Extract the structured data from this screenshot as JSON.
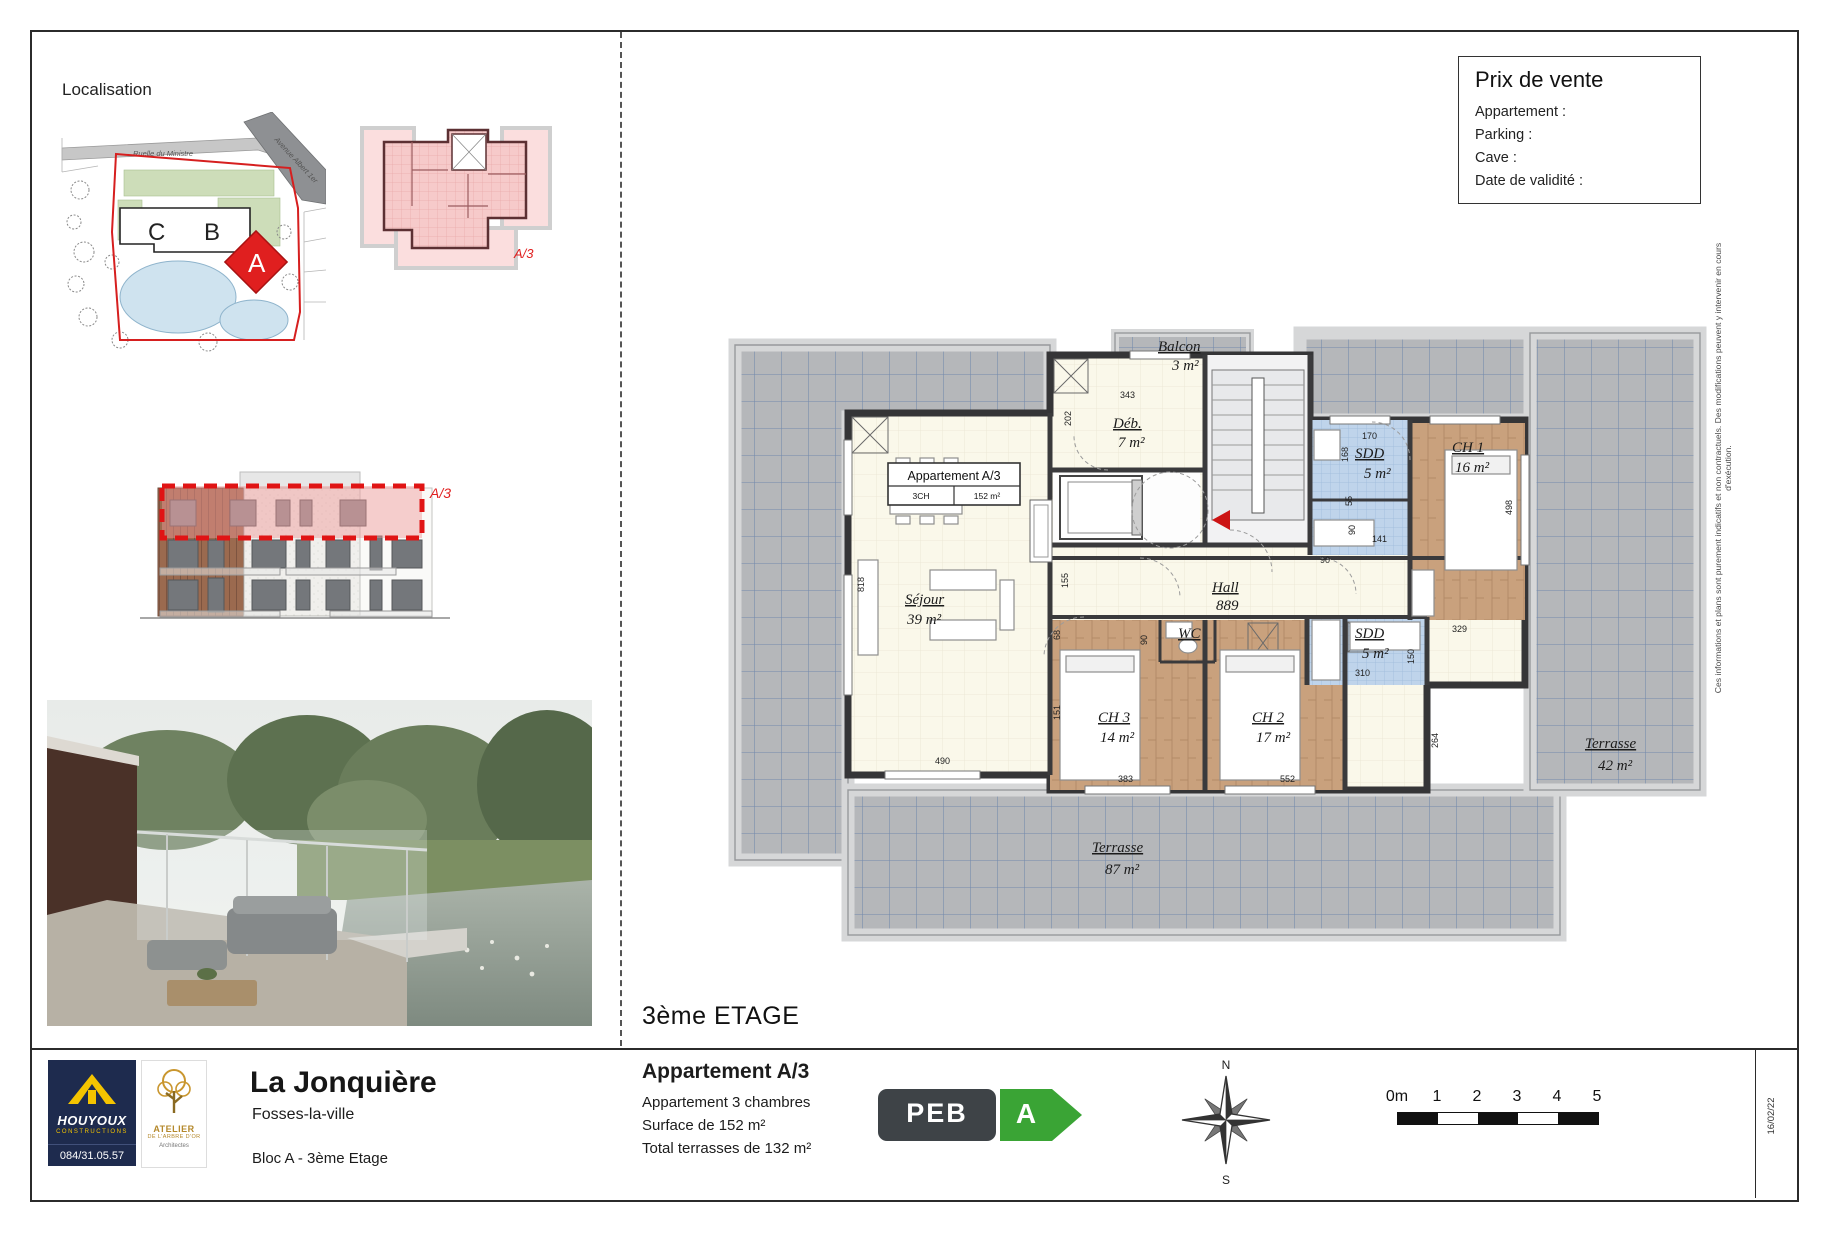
{
  "page": {
    "localisation_label": "Localisation",
    "floor_label": "3ème ETAGE",
    "date_label": "16/02/22",
    "disclaimer": "Ces informations et plans sont purement indicatifs et non contractuels. Des modifications peuvent y intervenir en cours d'exécution."
  },
  "price_box": {
    "title": "Prix de vente",
    "line1": "Appartement :",
    "line2": "Parking :",
    "line3": "Cave :",
    "line4": "Date de validité :"
  },
  "map": {
    "road1": "Ruelle du Ministre",
    "road2": "Avenue Albert 1er",
    "building_c": "C",
    "building_b": "B",
    "building_a": "A"
  },
  "keyplan": {
    "unit": "A/3"
  },
  "elevation": {
    "unit": "A/3"
  },
  "plan": {
    "unit_box": {
      "title": "Appartement A/3",
      "col1": "3CH",
      "col2": "152 m²"
    },
    "rooms": {
      "sejour": {
        "name": "Séjour",
        "area": "39 m²"
      },
      "deb": {
        "name": "Déb.",
        "area": "7 m²"
      },
      "hall": {
        "name": "Hall",
        "area": "889"
      },
      "sdd1": {
        "name": "SDD",
        "area": "5 m²"
      },
      "ch1": {
        "name": "CH 1",
        "area": "16 m²"
      },
      "wc": {
        "name": "WC"
      },
      "ch3": {
        "name": "CH 3",
        "area": "14 m²"
      },
      "ch2": {
        "name": "CH 2",
        "area": "17 m²"
      },
      "sdd2": {
        "name": "SDD",
        "area": "5 m²"
      },
      "balcon": {
        "name": "Balcon",
        "area": "3 m²"
      },
      "terrasse_right": {
        "name": "Terrasse",
        "area": "42 m²"
      },
      "terrasse_bottom": {
        "name": "Terrasse",
        "area": "87 m²"
      }
    },
    "dims": {
      "d343": "343",
      "d202": "202",
      "d818": "818",
      "d490": "490",
      "d155": "155",
      "d68": "68",
      "d151": "151",
      "d170": "170",
      "d168": "168",
      "d55": "55",
      "d90a": "90",
      "d141": "141",
      "d90b": "90",
      "d90c": "90",
      "d310": "310",
      "d150": "150",
      "d383": "383",
      "d552": "552",
      "d264": "264",
      "d329": "329",
      "d498": "498"
    }
  },
  "titleblock": {
    "project": "La Jonquière",
    "city": "Fosses-la-ville",
    "block": "Bloc A - 3ème Etage",
    "apartment_title": "Appartement A/3",
    "apartment_desc": "Appartement 3 chambres",
    "surface": "Surface de 152 m²",
    "terraces": "Total terrasses de 132 m²",
    "houyoux": {
      "name": "HOUYOUX",
      "sub": "CONSTRUCTIONS",
      "phone": "084/31.05.57"
    },
    "atelier": {
      "line1": "ATELIER",
      "line2": "DE L'ARBRE D'OR",
      "line3": "Architectes"
    },
    "peb": {
      "label": "PEB",
      "grade": "A"
    },
    "compass": {
      "n": "N",
      "s": "S"
    },
    "scale": {
      "labels": [
        "0m",
        "1",
        "2",
        "3",
        "4",
        "5"
      ]
    }
  }
}
